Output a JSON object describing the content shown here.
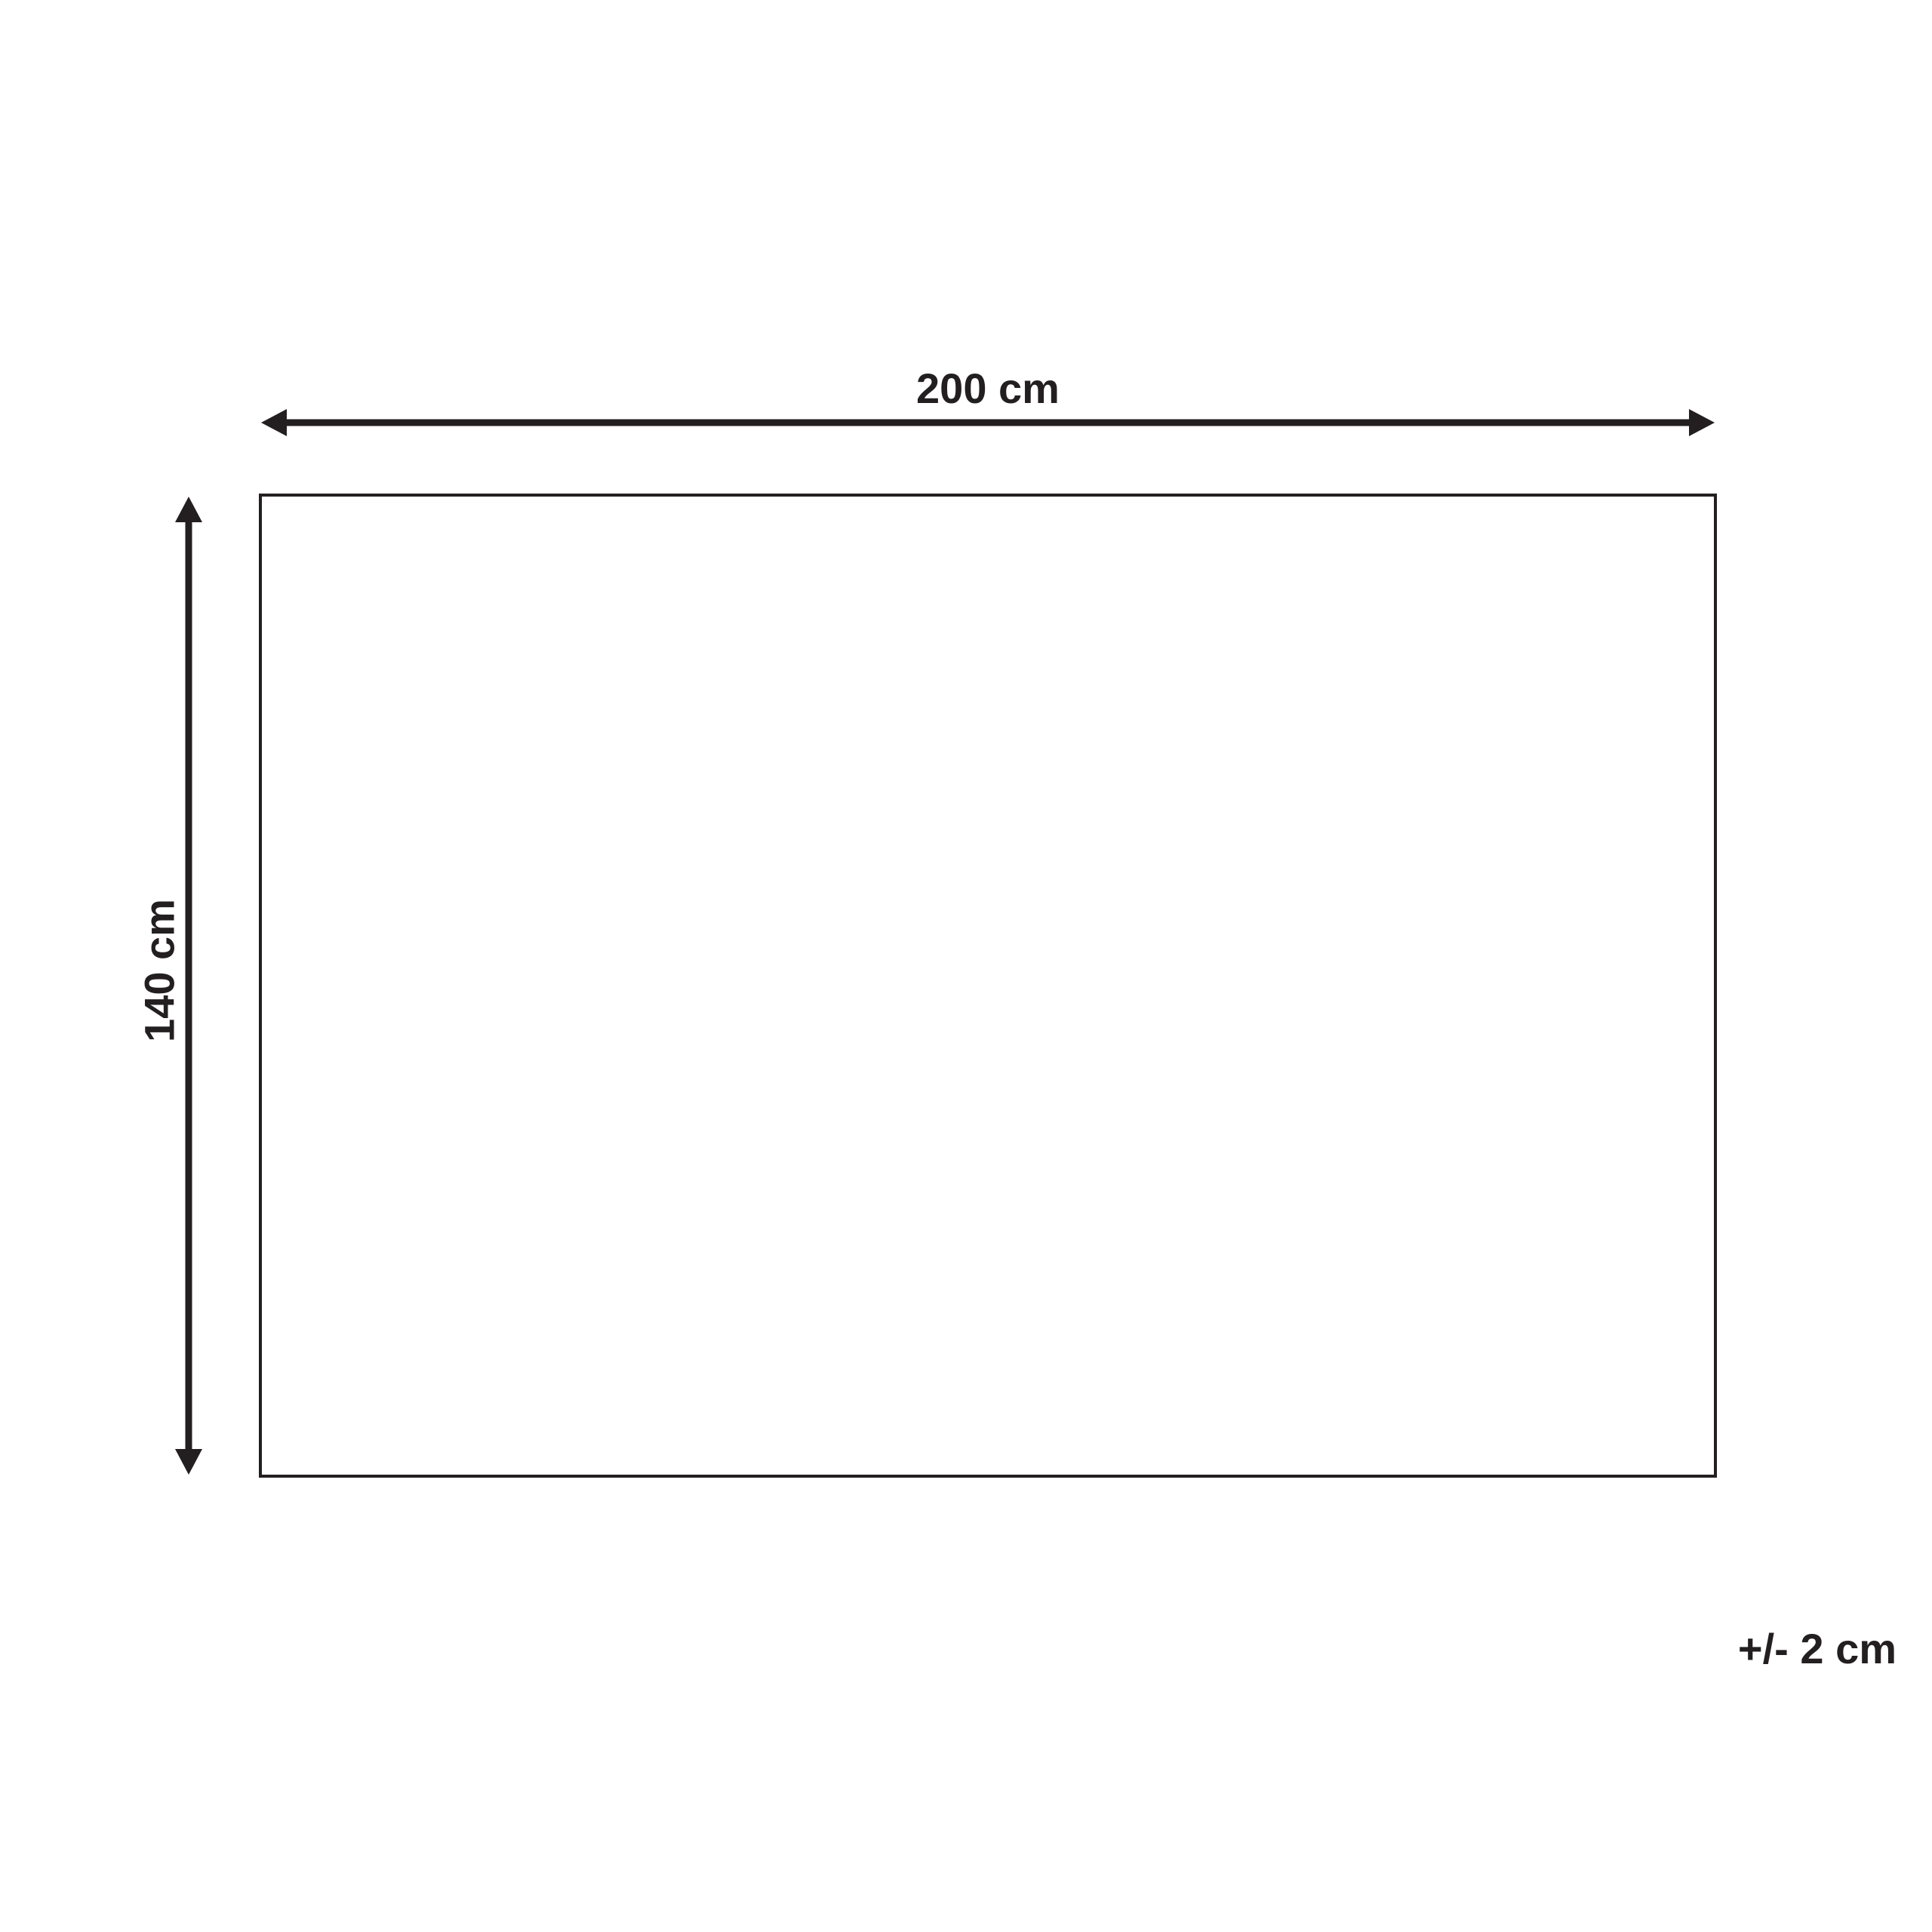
{
  "figure": {
    "type": "product-dimension-diagram",
    "width_label": "200 cm",
    "height_label": "140 cm",
    "tolerance_label": "+/- 2 cm"
  },
  "colors": {
    "ink": "#231f20",
    "background": "#ffffff"
  }
}
